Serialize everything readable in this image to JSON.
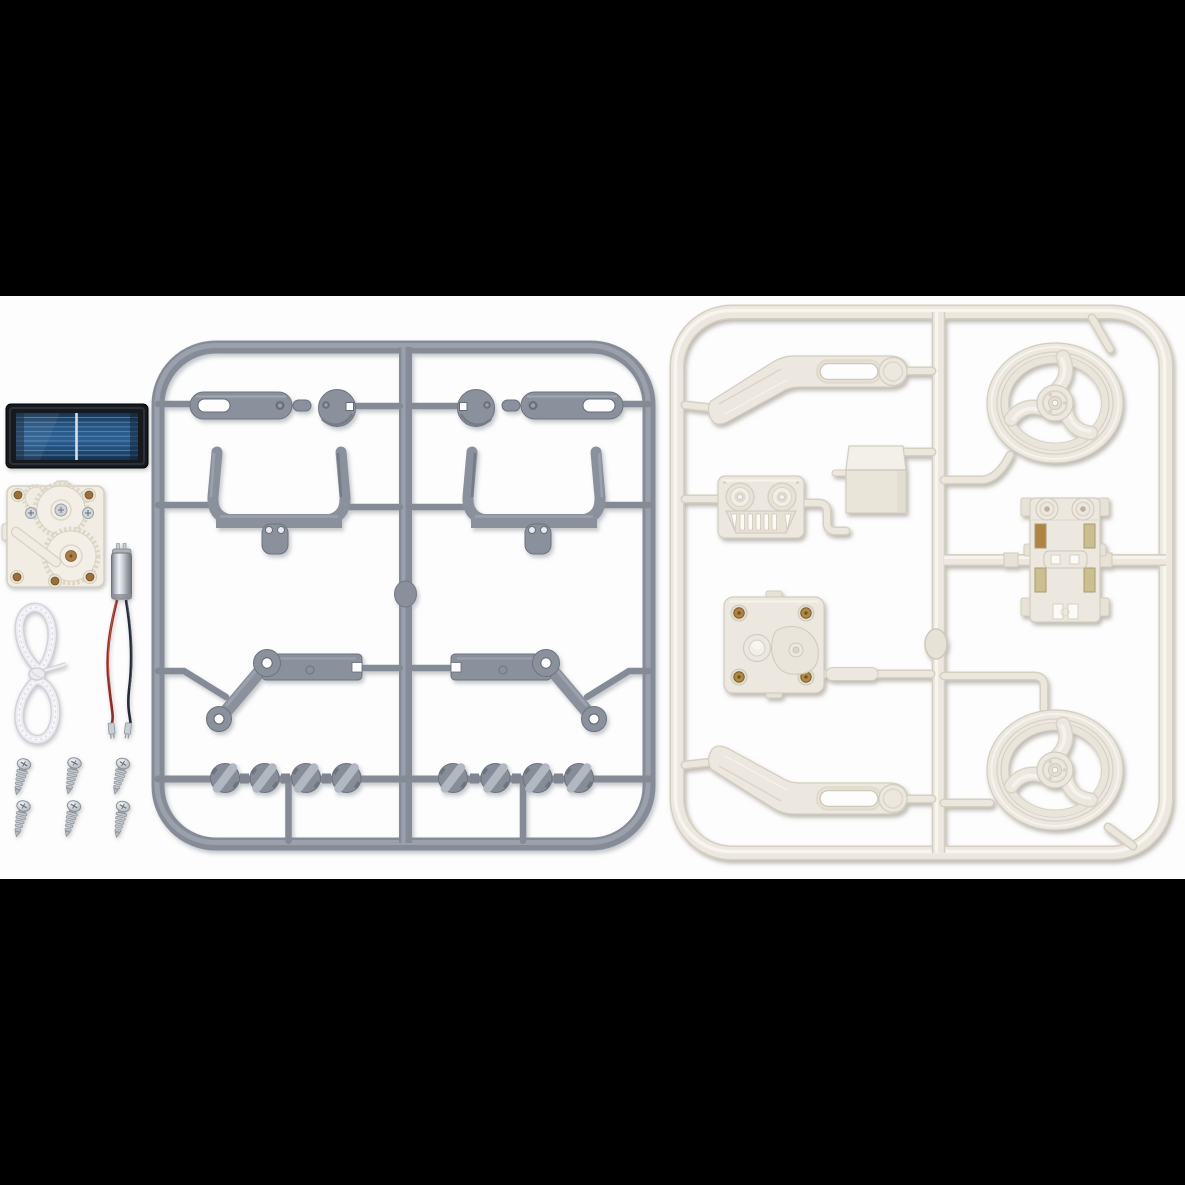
{
  "scene": {
    "description": "Product photo of a solar robot model kit: loose electrical components at left beside a gray injection-molded parts sprue and an ivory injection-molded parts sprue on a white background with black letterbox bars",
    "background": "#000000",
    "photo_background": "#fdfdfd"
  },
  "colors": {
    "background": "#000000",
    "photo_background": "#fdfdfd",
    "gray_base": "#868c97",
    "gray_fill": "#8b919c",
    "gray_dark": "#6d737e",
    "gray_light": "#a6acb6",
    "cream_base": "#ece8df",
    "cream_dark": "#d5cfc1",
    "cream_light": "#f7f5ee",
    "solar_frame": "#16191e",
    "solar_cell_blue": "#2a5c8c",
    "solar_busbar": "#7ea8cd",
    "wire_red": "#8f2d24",
    "wire_dark": "#232b36",
    "brass": "#ae8343",
    "metal": "#c6cbd1",
    "cord_white": "#ececf1"
  },
  "loose_parts": {
    "solar_panel": {
      "label": "solar cell panel"
    },
    "gearbox": {
      "label": "white gearbox with toothed gears and brass posts"
    },
    "motor": {
      "label": "silver vibration motor with red and dark lead wires"
    },
    "cord": {
      "label": "white nylon cord tied in a bow"
    },
    "screws": {
      "label": "self-tapping screws",
      "count": 6,
      "rows": 2,
      "per_row": 3
    }
  },
  "gray_sprue": {
    "label": "gray plastic parts sprue",
    "color": "#8b919c",
    "parts": [
      "slotted lever arm x2",
      "round cam disc x2",
      "U-shaped bumper bracket x2",
      "angled linkage arm x2",
      "ribbed knob pulley x8"
    ]
  },
  "white_sprue": {
    "label": "ivory plastic parts sprue",
    "color": "#ece8df",
    "parts": [
      "curved slotted arm x2",
      "three-spoke wheel x2",
      "robot face grille plate",
      "folded box bracket",
      "gearbox cover plate with brass bushings",
      "chassis plate with clips"
    ]
  }
}
